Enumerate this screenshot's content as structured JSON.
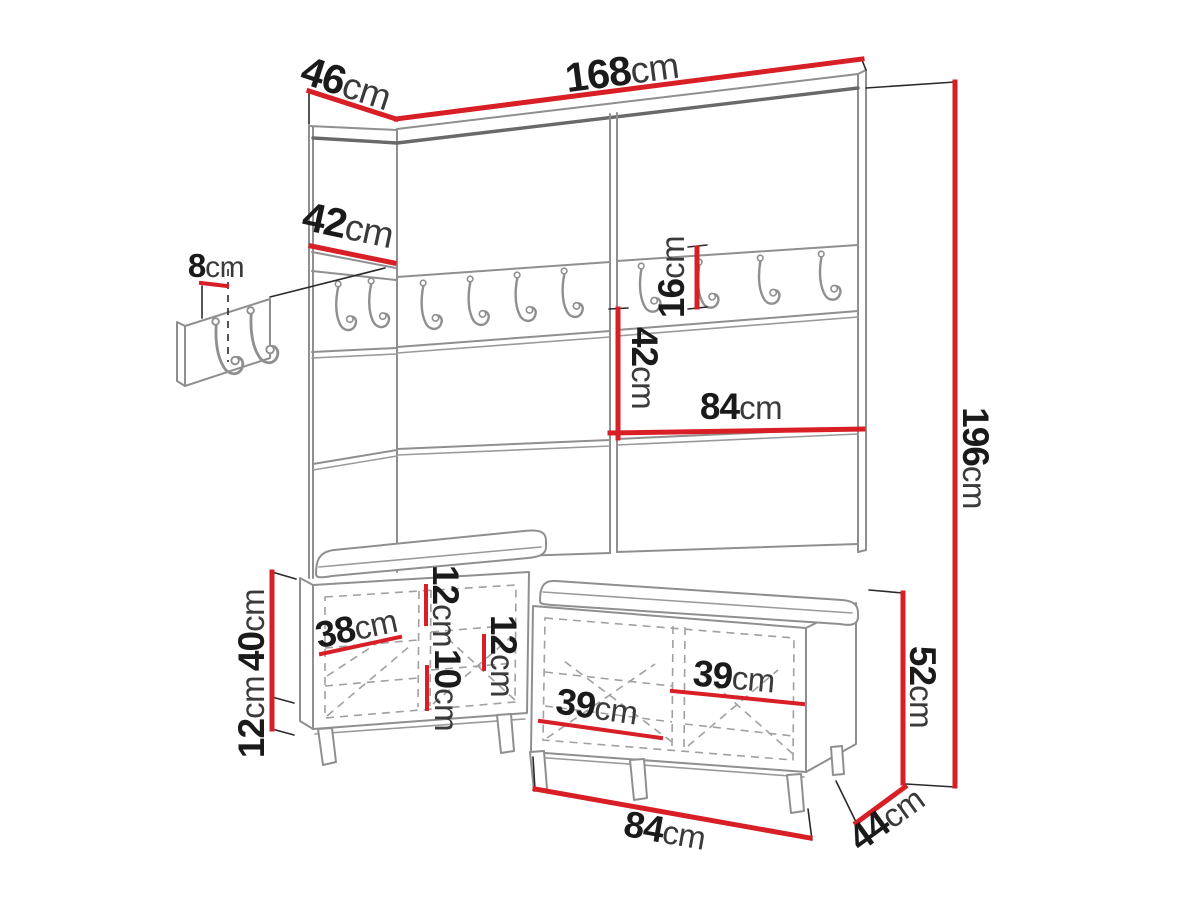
{
  "labels": {
    "top_depth": {
      "value": "46",
      "unit": "cm"
    },
    "top_width": {
      "value": "168",
      "unit": "cm"
    },
    "left_panel": {
      "value": "42",
      "unit": "cm"
    },
    "hook_detail": {
      "value": "8",
      "unit": "cm"
    },
    "rail_height": {
      "value": "16",
      "unit": "cm"
    },
    "mid_height": {
      "value": "42",
      "unit": "cm"
    },
    "mid_width": {
      "value": "84",
      "unit": "cm"
    },
    "total_height": {
      "value": "196",
      "unit": "cm"
    },
    "bench_box_height": {
      "value": "40",
      "unit": "cm"
    },
    "leg_height": {
      "value": "12",
      "unit": "cm"
    },
    "bench_inner_diag": {
      "value": "38",
      "unit": "cm"
    },
    "inner_top": {
      "value": "12",
      "unit": "cm"
    },
    "inner_gap": {
      "value": "10",
      "unit": "cm"
    },
    "inner_mid": {
      "value": "12",
      "unit": "cm"
    },
    "shelf_mid": {
      "value": "39",
      "unit": "cm"
    },
    "shelf_right": {
      "value": "39",
      "unit": "cm"
    },
    "bench_total_height": {
      "value": "52",
      "unit": "cm"
    },
    "bench_width": {
      "value": "84",
      "unit": "cm"
    },
    "bench_depth": {
      "value": "44",
      "unit": "cm"
    }
  },
  "colors": {
    "dimension_red": "#d81f26",
    "line_gray": "#8f8f8f",
    "edge_dark_gray": "#696969",
    "text": "#1a1a1a",
    "background": "#ffffff"
  }
}
